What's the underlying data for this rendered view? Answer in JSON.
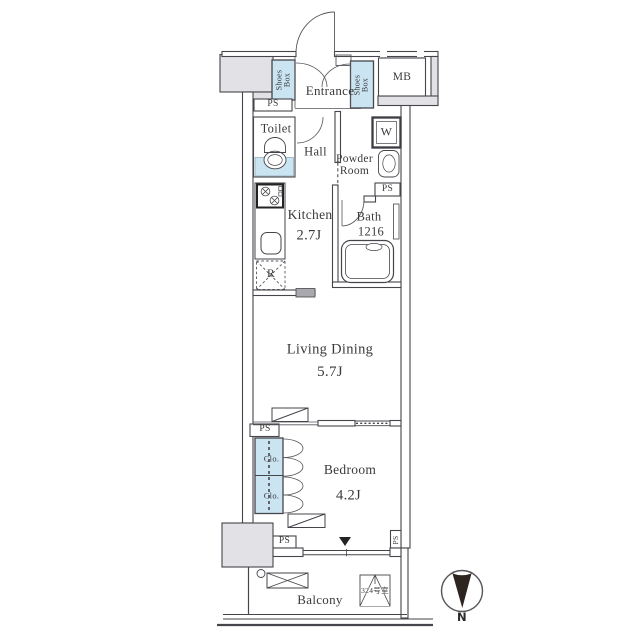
{
  "plan_type": "apartment-floorplan",
  "rooms": {
    "entrance": {
      "label": "Entrance"
    },
    "shoes_box_left": {
      "line1": "Shoes",
      "line2": "Box"
    },
    "shoes_box_right": {
      "line1": "Shoes",
      "line2": "Box"
    },
    "mb": {
      "label": "MB"
    },
    "toilet": {
      "label": "Toilet"
    },
    "hall": {
      "label": "Hall"
    },
    "powder_room": {
      "line1": "Powder",
      "line2": "Room"
    },
    "washer": {
      "label": "W"
    },
    "kitchen": {
      "label": "Kitchen",
      "size": "2.7J"
    },
    "bath": {
      "label": "Bath",
      "size": "1216"
    },
    "refrigerator": {
      "label": "R"
    },
    "living_dining": {
      "label": "Living Dining",
      "size": "5.7J"
    },
    "bedroom": {
      "label": "Bedroom",
      "size": "4.2J"
    },
    "closet_upper": {
      "label": "Clo."
    },
    "closet_lower": {
      "label": "Clo."
    },
    "balcony": {
      "label": "Balcony"
    }
  },
  "pipe_shafts": {
    "ps1": "PS",
    "ps2": "PS",
    "ps3": "PS",
    "ps4": "PS",
    "ps5": "PS"
  },
  "unit": {
    "room_number": "324号室"
  },
  "compass": {
    "north_label": "N"
  },
  "colors": {
    "storage_fill": "#cae4f2",
    "common_area_fill": "#e2e2e6",
    "wall_stroke": "#45454b",
    "text": "#3a3a3a",
    "compass_needle": "#2e2420"
  }
}
